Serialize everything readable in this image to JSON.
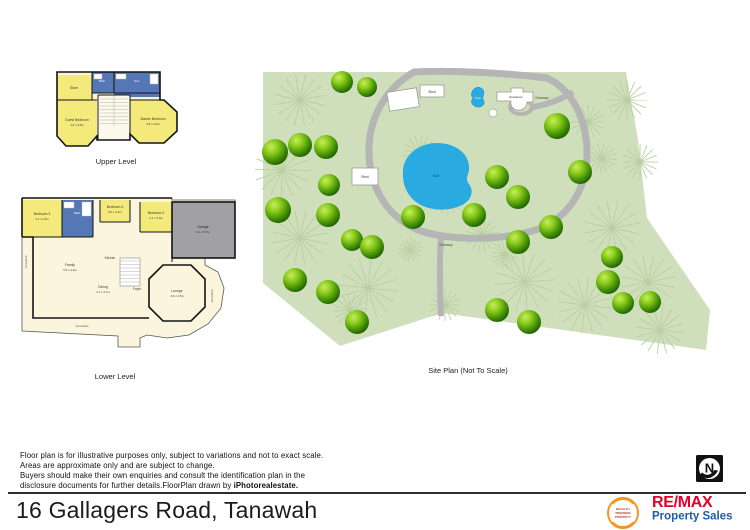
{
  "title": "16 Gallagers Road, Tanawah",
  "disclaimer": {
    "line1": "Floor plan is for illustrative purposes only, subject to variations and not to exact scale.",
    "line2": "Areas are approximate only and are subject to change.",
    "line3": "Buyers should make their own enquiries and consult the identification plan in the",
    "line4_normal": "disclosure documents for further details.FloorPlan drawn by ",
    "line4_bold": "iPhotorealestate."
  },
  "upper_plan": {
    "caption": "Upper Level",
    "rooms": {
      "store": {
        "name": "Store"
      },
      "bath": {
        "name": "Bath"
      },
      "ens": {
        "name": "Ens"
      },
      "guest": {
        "name": "Guest Bedroom",
        "dims": "4.5 x 4.0m"
      },
      "master": {
        "name": "Master Bedroom",
        "dims": "4.8 x 4.0m"
      }
    }
  },
  "lower_plan": {
    "caption": "Lower Level",
    "rooms": {
      "bedroom3": {
        "name": "Bedroom 3",
        "dims": "4.1 x 2.6m"
      },
      "bath": {
        "name": "Bath"
      },
      "bedroom4": {
        "name": "Bedroom 4",
        "dims": "3.0 x 2.4m"
      },
      "bedroom2": {
        "name": "Bedroom 2",
        "dims": "4.1 x 3.0m"
      },
      "garage": {
        "name": "Garage",
        "dims": "6.1 x 5.7m"
      },
      "family": {
        "name": "Family",
        "dims": "5.5 x 4.9m"
      },
      "kitchen": {
        "name": "Kitchen"
      },
      "dining": {
        "name": "Dining",
        "dims": "4.1 x 3.7m"
      },
      "foyer": {
        "name": "Foyer"
      },
      "lounge": {
        "name": "Lounge",
        "dims": "4.9 x 4.5m"
      },
      "verandah": {
        "name": "Verandah"
      }
    }
  },
  "site_plan": {
    "caption": "Site Plan (Not To Scale)",
    "labels": {
      "shed_top": "Shed",
      "shed_mid": "Shed",
      "pool": "Pool",
      "residence": "Residence",
      "dam": "Dam",
      "driveway_top": "Driveway",
      "driveway_mid": "Driveway"
    },
    "trees": [
      [
        342,
        82,
        11
      ],
      [
        367,
        87,
        10
      ],
      [
        275,
        152,
        13
      ],
      [
        300,
        145,
        12
      ],
      [
        326,
        147,
        12
      ],
      [
        557,
        126,
        13
      ],
      [
        329,
        185,
        11
      ],
      [
        278,
        210,
        13
      ],
      [
        328,
        215,
        12
      ],
      [
        580,
        172,
        12
      ],
      [
        497,
        177,
        12
      ],
      [
        518,
        197,
        12
      ],
      [
        413,
        217,
        12
      ],
      [
        474,
        215,
        12
      ],
      [
        352,
        240,
        11
      ],
      [
        372,
        247,
        12
      ],
      [
        551,
        227,
        12
      ],
      [
        518,
        242,
        12
      ],
      [
        295,
        280,
        12
      ],
      [
        328,
        292,
        12
      ],
      [
        612,
        257,
        11
      ],
      [
        608,
        282,
        12
      ],
      [
        623,
        303,
        11
      ],
      [
        650,
        302,
        11
      ],
      [
        357,
        322,
        12
      ],
      [
        497,
        310,
        12
      ],
      [
        529,
        322,
        12
      ]
    ],
    "faint_trees": [
      [
        300,
        100,
        26
      ],
      [
        282,
        170,
        28
      ],
      [
        300,
        238,
        28
      ],
      [
        368,
        288,
        30
      ],
      [
        420,
        152,
        17
      ],
      [
        448,
        198,
        17
      ],
      [
        482,
        235,
        17
      ],
      [
        525,
        282,
        30
      ],
      [
        585,
        305,
        28
      ],
      [
        612,
        228,
        28
      ],
      [
        648,
        282,
        28
      ],
      [
        588,
        122,
        17
      ],
      [
        602,
        158,
        15
      ],
      [
        627,
        100,
        20
      ],
      [
        445,
        305,
        16
      ],
      [
        660,
        330,
        24
      ],
      [
        350,
        310,
        17
      ],
      [
        410,
        250,
        12
      ],
      [
        505,
        255,
        14
      ],
      [
        640,
        162,
        18
      ]
    ]
  },
  "branding": {
    "remax_name": "RE/MAX",
    "remax_tagline": "Property Sales",
    "badge_line1": "BEAGLEY",
    "badge_line2": "PREMIERE",
    "badge_line3": "PROPERTY",
    "north_letter": "N"
  },
  "colors": {
    "site_green": "#cfdfbc",
    "tree_dark": "#1d5c00",
    "tree_light": "#aadc32",
    "water_blue": "#29abe2",
    "driveway_gray": "#b5b5b5",
    "room_yellow": "#f3ea7b",
    "room_blue": "#5577b5",
    "room_cream": "#fbf3d8",
    "garage_gray": "#a1a1a3",
    "remax_red": "#e4002b",
    "remax_blue": "#1f5ca8",
    "badge_orange": "#f7941d"
  }
}
